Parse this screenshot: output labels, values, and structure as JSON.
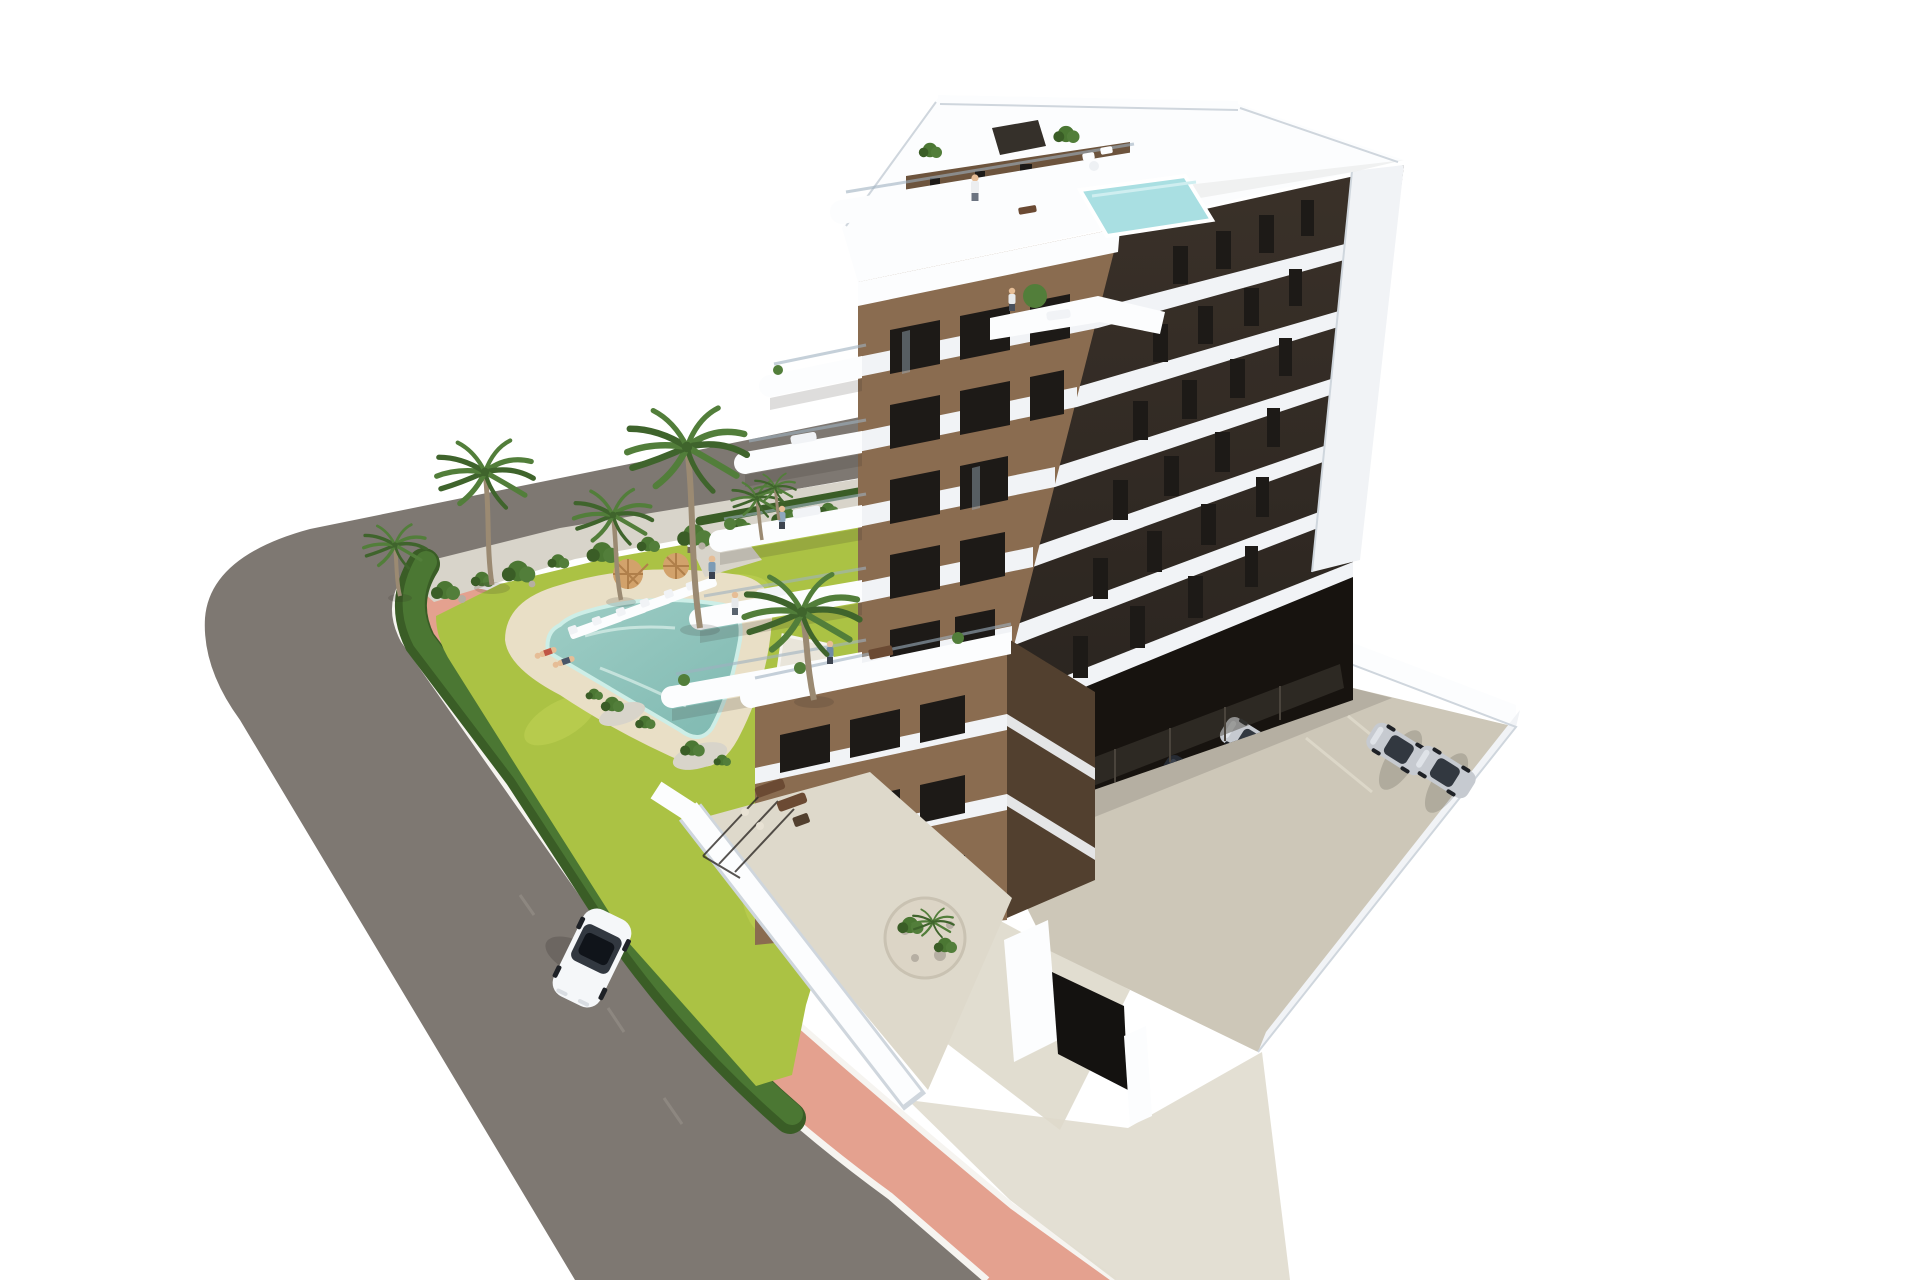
{
  "scene": {
    "type": "architectural-render",
    "description": "Aerial 3D rendering of a modern seven-storey apartment building with white curved balconies and brown facade panels, a rooftop terrace with a small pool, a landscaped garden with a free-form swimming pool, sun loungers, parasols and palm trees, a pink pedestrian sidewalk along a gray asphalt road with one white car, and a parking area with silver cars beside and beneath the building.",
    "background": "plain white"
  },
  "colors": {
    "road": "#7e7872",
    "curb": "#f6f4f0",
    "pink": "#e4a18f",
    "gravel": "#d8d4ca",
    "hedge": "#4b7733",
    "hedge_dark": "#3a5d26",
    "lawn": "#abc244",
    "deck": "#e9dfc6",
    "pool1": "#9ecdc5",
    "pool2": "#7fb9b1",
    "roof_pool": "#a9dfe2",
    "white": "#f1f3f6",
    "white_bright": "#fcfdfe",
    "white_shade": "#cfd6dd",
    "brown": "#8a6c50",
    "brown_dark": "#6d543d",
    "brown_deep": "#52402f",
    "dark_facade": "#3a3129",
    "dark_facade2": "#2b2520",
    "window": "#1d1a17",
    "glass": "#9fb1bf",
    "pad": "#cdc7b8",
    "pad_light": "#ded9cb",
    "void": "#17130f",
    "mesh": "#4a443c",
    "car_white": "#f5f7f9",
    "car_silver": "#c6cad0",
    "car_glass": "#323840",
    "wheel": "#1e2126",
    "trunk": "#9b8a72",
    "frond": "#527e3a",
    "frond_dark": "#3f642c",
    "skin": "#e6bd96",
    "umb": "#d2a26b",
    "umb_dark": "#b07f4a",
    "rock": "#b6afa3",
    "planter": "#dcd5c6",
    "wood": "#6b4a33",
    "shadow": "#2f2b26"
  },
  "building": {
    "storeys_visible": 7,
    "facade_materials": [
      "white concrete bands",
      "brown stucco panels",
      "dark brown end wall"
    ],
    "balcony_style": "white pill-shaped curved slabs with glass railings",
    "rooftop": {
      "terrace": true,
      "plunge_pool": true,
      "plants": 2,
      "pergola_box": 1
    },
    "ground_level": {
      "covered_parking": true,
      "garden_terraces": true,
      "entrance_gate": true
    }
  },
  "garden": {
    "swimming_pool": "free-form rounded triangle",
    "sun_loungers": 6,
    "parasols": 2,
    "palm_trees": 7,
    "hedge_border": true,
    "lawn": true,
    "gravel_planting_beds": true
  },
  "street": {
    "asphalt_road": true,
    "pink_sidewalk": true,
    "white_curbs": true,
    "cars_on_road": 1,
    "road_car_color": "white"
  },
  "parking": {
    "surface_lot_cars": 2,
    "surface_lot_car_colors": [
      "silver",
      "silver"
    ],
    "under_building_cars_visible": 4,
    "mesh_fence": true,
    "white_perimeter_walls": true
  },
  "people_visible": 9
}
